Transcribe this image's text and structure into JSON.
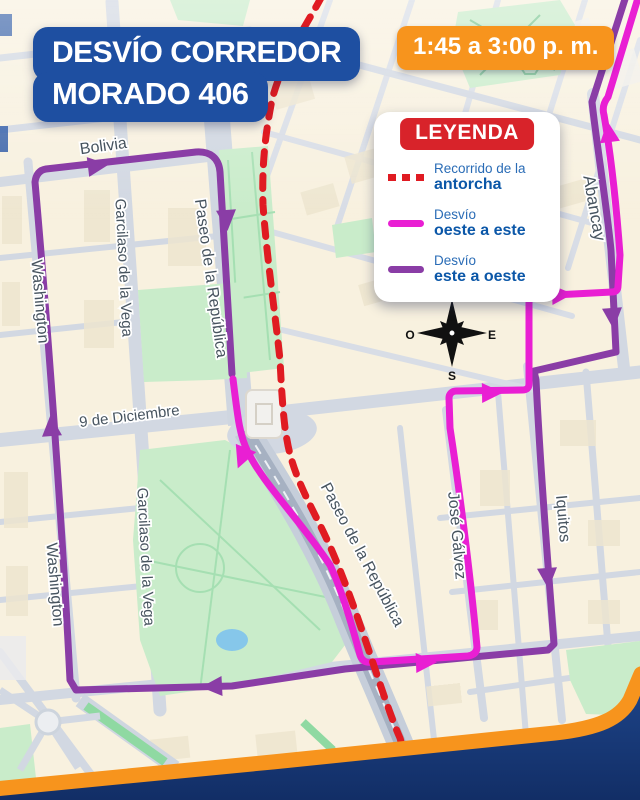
{
  "title": {
    "line1": "DESVÍO CORREDOR",
    "line2": "MORADO 406"
  },
  "time_badge": "1:45 a 3:00 p. m.",
  "legend": {
    "header": "LEYENDA",
    "items": [
      {
        "line1": "Recorrido de la",
        "line2": "antorcha",
        "style": "dashed-red"
      },
      {
        "line1": "Desvío",
        "line2": "oeste a este",
        "style": "solid-magenta"
      },
      {
        "line1": "Desvío",
        "line2": "este a oeste",
        "style": "solid-purple"
      }
    ]
  },
  "compass": {
    "north": "N",
    "south": "S",
    "east": "E",
    "west": "O"
  },
  "streets": {
    "bolivia": "Bolivia",
    "washington_upper": "Washington",
    "washington_lower": "Washington",
    "garcilaso_upper": "Garcilaso de la Vega",
    "garcilaso_lower": "Garcilaso de la Vega",
    "paseo_upper": "Paseo de la República",
    "paseo_lower": "Paseo de la República",
    "nueve_de_diciembre": "9 de Diciembre",
    "abancay": "Abancay",
    "jose_galvez": "José Gálvez",
    "iquitos": "Iquitos"
  },
  "colors": {
    "torch_route": "#e01b22",
    "detour_west_east": "#e91fd3",
    "detour_east_west": "#8a3da6",
    "title_bg": "#1e4fa1",
    "badge_bg": "#f7941d",
    "legend_header_bg": "#d8232a",
    "frame_orange": "#f7941d",
    "frame_navy": "#16356f",
    "map_background": "#f8f1df",
    "street_gray": "#d2d8e2",
    "park_green": "#c9ecca",
    "expressway_gray": "#a6b1c2"
  }
}
